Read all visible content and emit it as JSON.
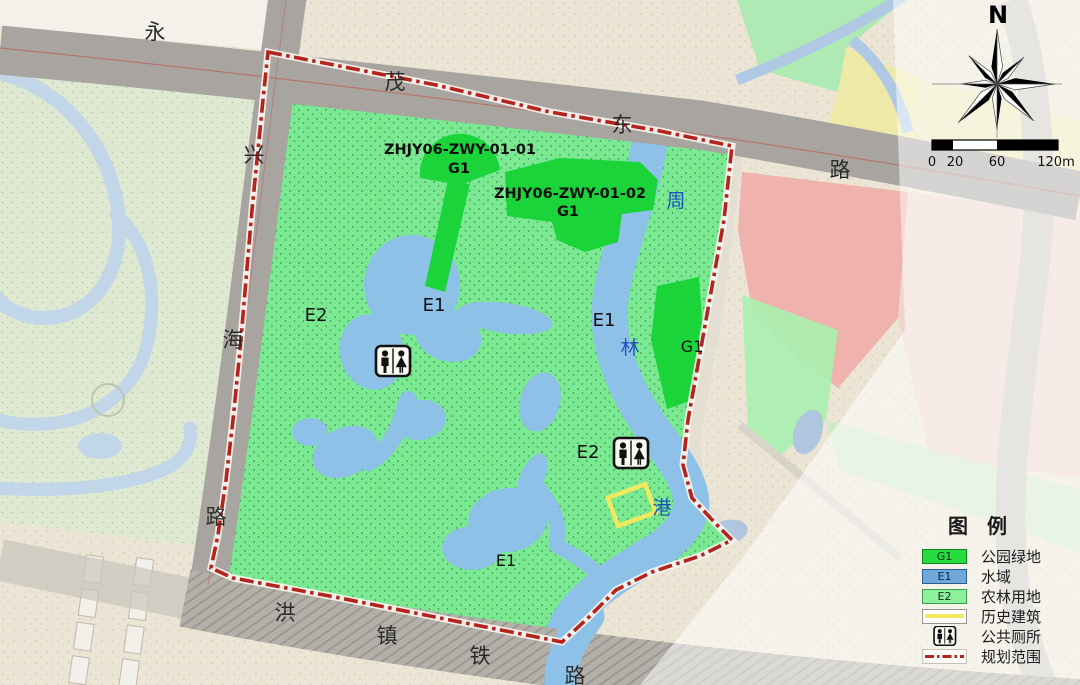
{
  "map_labels": {
    "road_north": [
      "永",
      "茂",
      "东",
      "路"
    ],
    "road_west": [
      "兴",
      "海",
      "路"
    ],
    "road_south": [
      "洪",
      "镇",
      "铁",
      "路"
    ],
    "river": [
      "周",
      "林",
      "港"
    ],
    "zones": {
      "e2_west": "E2",
      "e1_lake": "E1",
      "e1_river": "E1",
      "e2_south": "E2",
      "e1_south": "E1",
      "g1_east": "G1"
    },
    "plots": {
      "p1_code": "ZHJY06-ZWY-01-01",
      "p1_type": "G1",
      "p2_code": "ZHJY06-ZWY-01-02",
      "p2_type": "G1"
    }
  },
  "compass": {
    "north": "N"
  },
  "scale_bar": {
    "t0": "0",
    "t1": "20",
    "t2": "60",
    "t3": "120m"
  },
  "legend": {
    "title": "图 例",
    "items": [
      {
        "code": "G1",
        "label": "公园绿地",
        "color": "#25DD3F"
      },
      {
        "code": "E1",
        "label": "水域",
        "color": "#6FA9DC"
      },
      {
        "code": "E2",
        "label": "农林用地",
        "color": "#8DF09C"
      },
      {
        "code": "",
        "label": "历史建筑",
        "color": "#F2E95E"
      },
      {
        "code": "",
        "label": "公共厕所",
        "color": "#111111"
      },
      {
        "code": "",
        "label": "规划范围",
        "color": "#B3241E"
      }
    ]
  },
  "colors": {
    "park_green_e2": "#7BE892",
    "park_green_g1": "#1BD43A",
    "water": "#8EC1E8",
    "boundary_red": "#B3241E",
    "road_gray": "#A8A5A1"
  }
}
